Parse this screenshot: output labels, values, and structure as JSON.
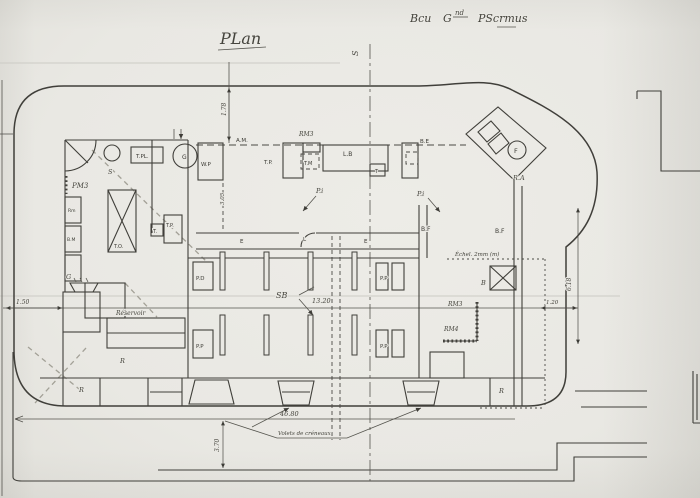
{
  "sheet": {
    "title": "PLan",
    "annotation": {
      "word1": "Bcu",
      "word2": "G",
      "word2_sup": "nd",
      "word3": "PScrmus"
    },
    "section_mark": "S"
  },
  "left_room": {
    "t_pl": "T.PL.",
    "stove": "S",
    "fan": "G",
    "pm3": "PM3",
    "locker_top": "Rm",
    "locker_bottom": "B.M",
    "table": "T.O.",
    "t_small": "T.",
    "t_p": "T.P."
  },
  "entrance": {
    "w_p": "W.P",
    "a_m": "A.M.",
    "t_p": "T.P.",
    "t_m": "T.M",
    "rm3": "RM3",
    "l_b": "L.B",
    "t": "T",
    "b_e": "B.E",
    "p_i_left": "P.i",
    "p_i_right": "P.i"
  },
  "embrasure": {
    "fan": "F",
    "r_a": "R.A"
  },
  "corridor": {
    "e_left": "E",
    "e_right": "E",
    "door": "L"
  },
  "casemate": {
    "name": "SB",
    "pier_nw": "P.D",
    "pier_sw": "P.P",
    "pier_ne": "P.P",
    "pier_se": "P.P",
    "b_f_left": "B.F",
    "b_f_right": "B.F"
  },
  "right_side": {
    "b": "B",
    "rm3": "RM3",
    "rm4": "RM4",
    "r": "R"
  },
  "bottom": {
    "reservoir": "Réservoir",
    "g": "G",
    "r_left": "R",
    "r_mid": "R"
  },
  "dimensions": {
    "left_wall": "1.50",
    "top_wall": "1.78",
    "entrance_depth": "3.05",
    "casemate_width": "13.20",
    "overall_width": "46.80",
    "right_height": "6.18",
    "right_offset": "1.20",
    "ditch_width": "3.70"
  },
  "notes": {
    "echelle": "Échel. 2mm (m)",
    "volets": "Volets de créneaux"
  }
}
